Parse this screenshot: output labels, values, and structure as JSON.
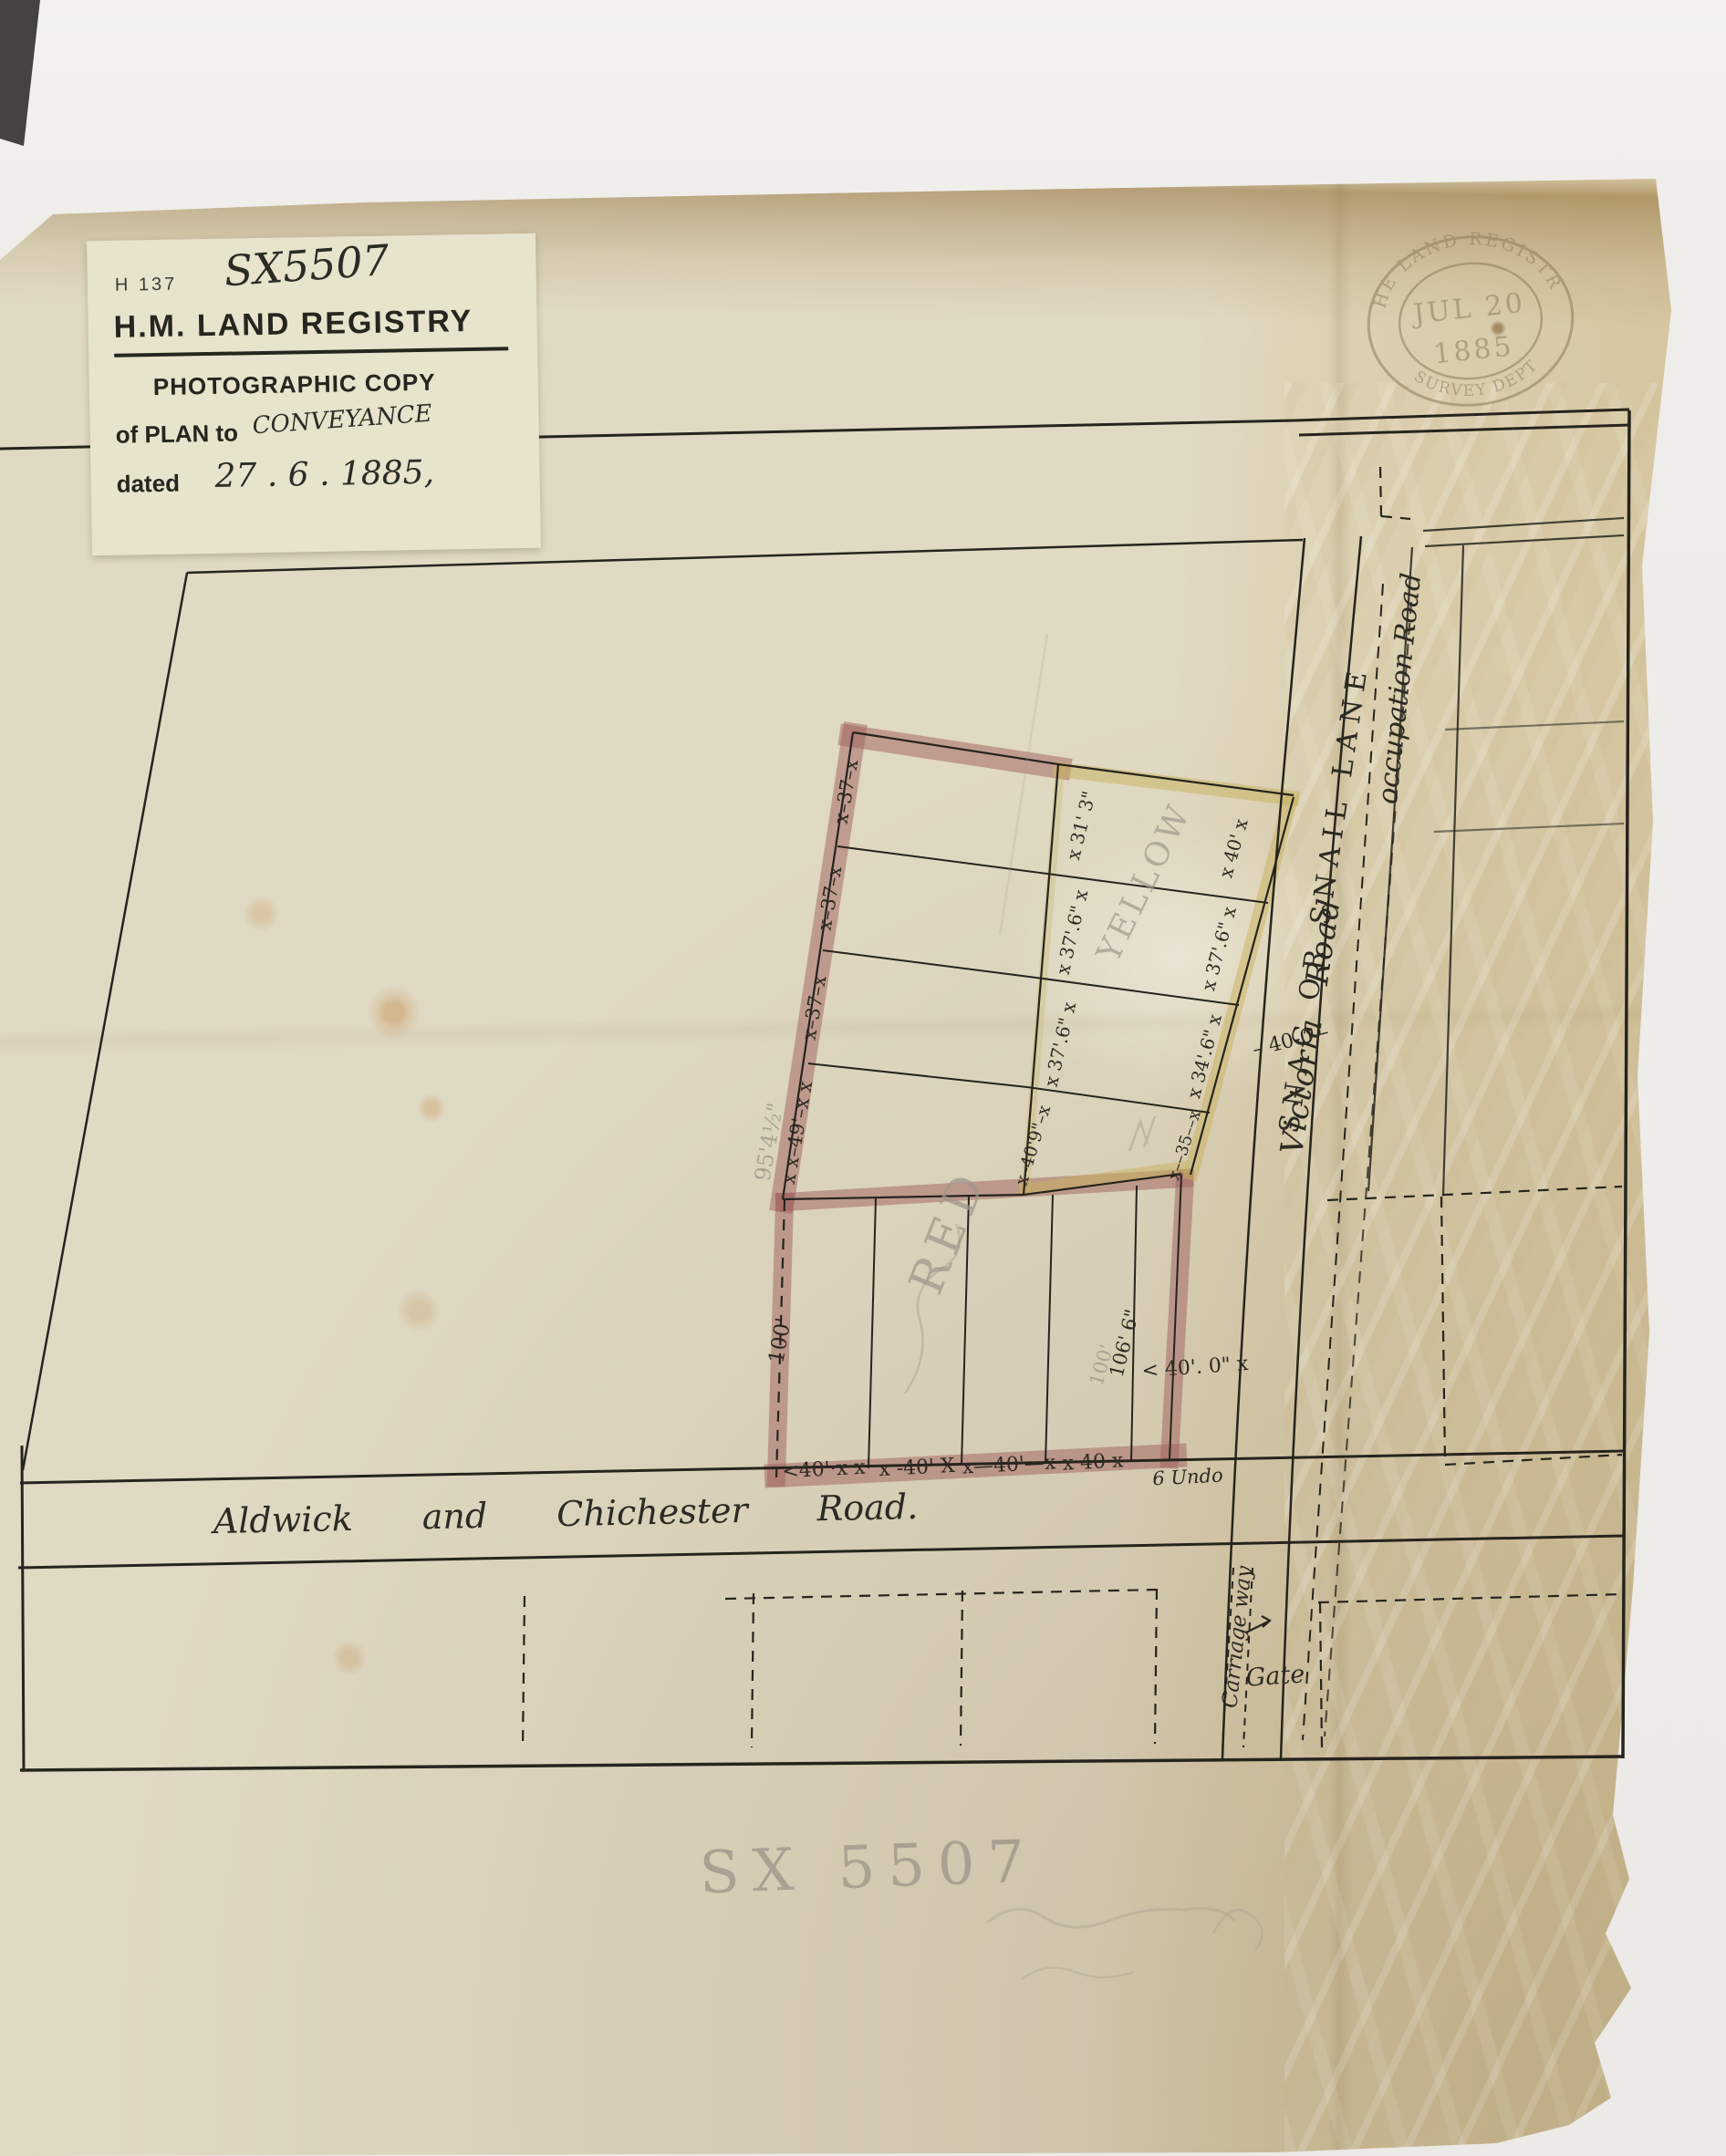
{
  "sticker": {
    "form_number": "H 137",
    "reference": "SX5507",
    "title": "H.M. LAND REGISTRY",
    "subtitle": "PHOTOGRAPHIC COPY",
    "plan_line_printed": "of PLAN to",
    "plan_line_handwritten": "CONVEYANCE",
    "date_label": "dated",
    "date_value": "27 . 6 . 1885,"
  },
  "stamp": {
    "arc_top": "THE LAND REGISTRY",
    "arc_bottom": "SURVEY DEPT",
    "date_line1": "JUL 20",
    "date_line2": "1885"
  },
  "roads": {
    "aldwick": "Aldwick and Chichester Road.",
    "lane_name_printed": "SNAG OR SNAIL LANE",
    "lane_name_cursive": "Victoria Road",
    "occupation": "occupation Road",
    "carriage_way": "Carriage way",
    "gate": "Gate",
    "frontage_note": "6 Undo"
  },
  "plot": {
    "pink": {
      "row_labels": [
        "x–37–x",
        "x–37–x",
        "x–37–x",
        "x x–49'–x x"
      ],
      "left_depth": "100'",
      "lot_labels": [
        "<40'·x x",
        "x -40' X",
        "x—40'—x",
        "x 40 x"
      ],
      "right_depth": "106' 6\"",
      "road_width": "< 40'. 0\" x",
      "lane_width": "– 40-0 –"
    },
    "yellow": {
      "boundary_labels": [
        "x 31' 3\"",
        "x 37'.6\" x",
        "x 37'.6\" x",
        "x–40'9\"–x"
      ],
      "road_labels": [
        "x 40' x",
        "x 37'.6\" x",
        "x 34'.6\" x",
        "x––35––x"
      ]
    }
  },
  "pencil": {
    "red": "RED",
    "yellow": "YELLOW",
    "left_dim": "95'4½\"",
    "depth_dim": "100'",
    "sheet_ref": "SX 5507"
  },
  "colors": {
    "ink": "#26241d",
    "red_wash": "#a05f5d",
    "yellow_wash": "#c8b25c",
    "pencil": "#9f988b",
    "paper": "#e0d9c3",
    "sticker_bg": "#e8e3cc"
  }
}
